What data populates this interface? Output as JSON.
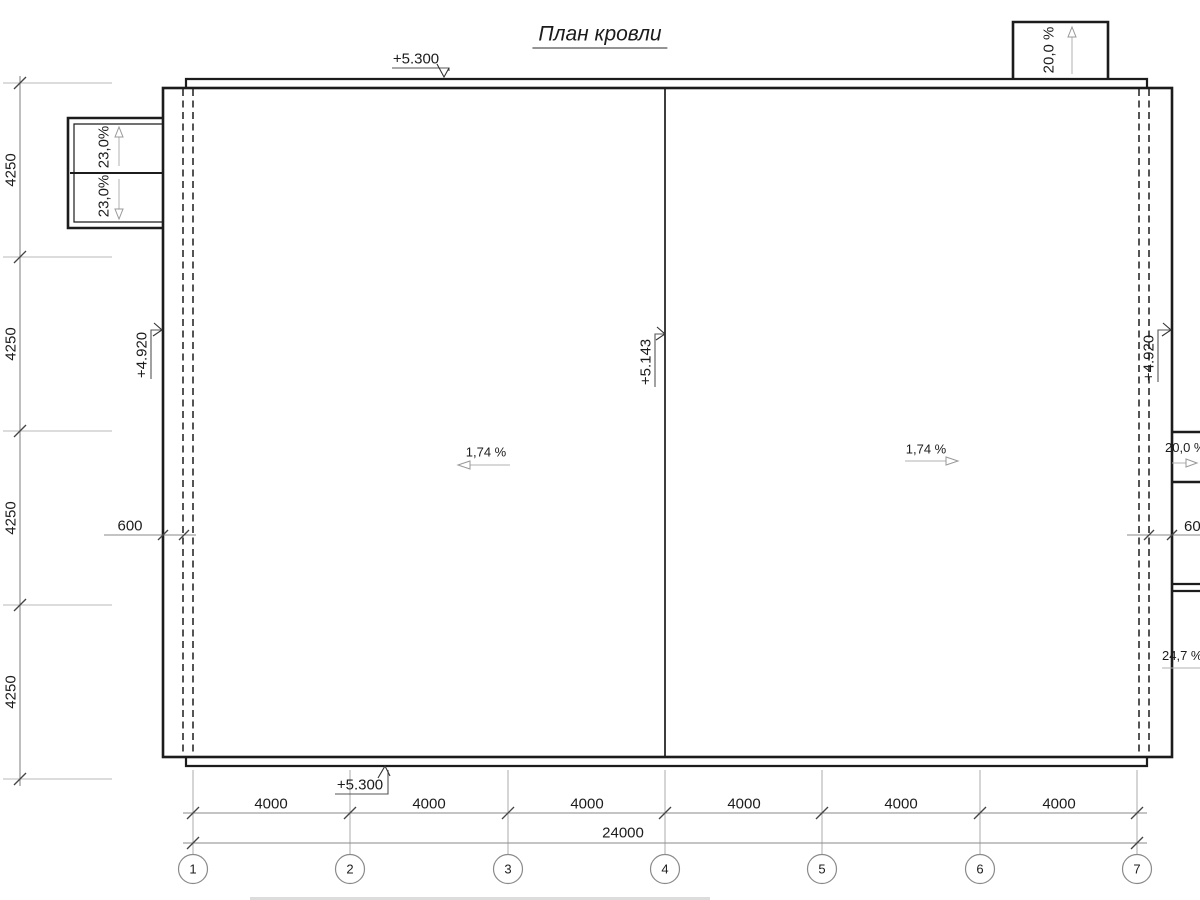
{
  "title": "План кровли",
  "slopes": {
    "main_left": "1,74 %",
    "main_right": "1,74 %",
    "left_canopy_upper": "23,0%",
    "left_canopy_lower": "23,0%",
    "top_canopy": "20,0 %",
    "right_canopy_upper": "20,0 %",
    "right_canopy_lower": "24,7 %"
  },
  "elevations": {
    "parapet_top": "+5.300",
    "parapet_bottom": "+5.300",
    "gutter_left": "+4.920",
    "gutter_right": "+4.920",
    "ridge": "+5.143"
  },
  "dimensions": {
    "bottom_bays": [
      "4000",
      "4000",
      "4000",
      "4000",
      "4000",
      "4000"
    ],
    "bottom_total": "24000",
    "left_bays": [
      "4250",
      "4250",
      "4250",
      "4250"
    ],
    "overhang_left": "600",
    "overhang_right": "600"
  },
  "grid": {
    "columns": [
      "1",
      "2",
      "3",
      "4",
      "5",
      "6",
      "7"
    ]
  }
}
